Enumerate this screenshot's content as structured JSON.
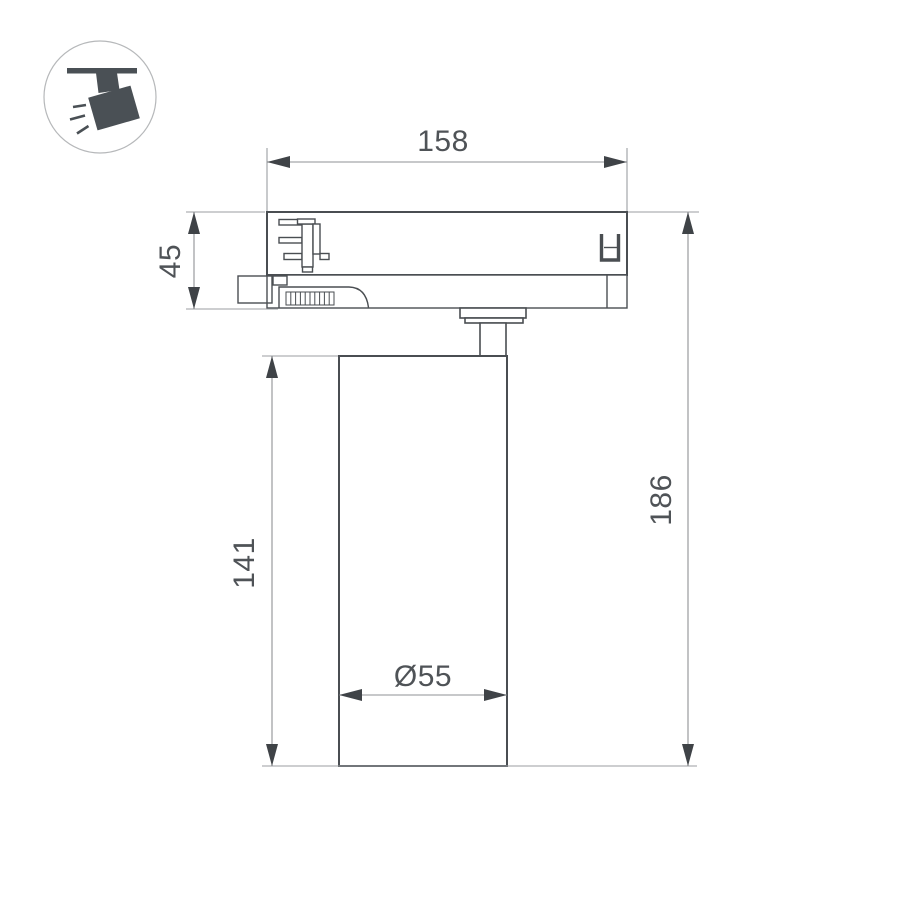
{
  "drawing": {
    "kind": "technical-dimension-drawing",
    "icon": "track-spotlight-icon",
    "dimensions": {
      "adapter_width": "158",
      "adapter_height": "45",
      "body_height": "141",
      "total_height": "186",
      "body_diameter": "Ø55"
    },
    "colors": {
      "background": "#ffffff",
      "outline": "#4a4e52",
      "dimension_line": "#8f9295",
      "extension_line": "#9b9ea1",
      "arrow": "#3f4347",
      "text": "#4f5357",
      "icon_fill": "#4a5055",
      "icon_circle_border": "#b6b8ba"
    }
  }
}
